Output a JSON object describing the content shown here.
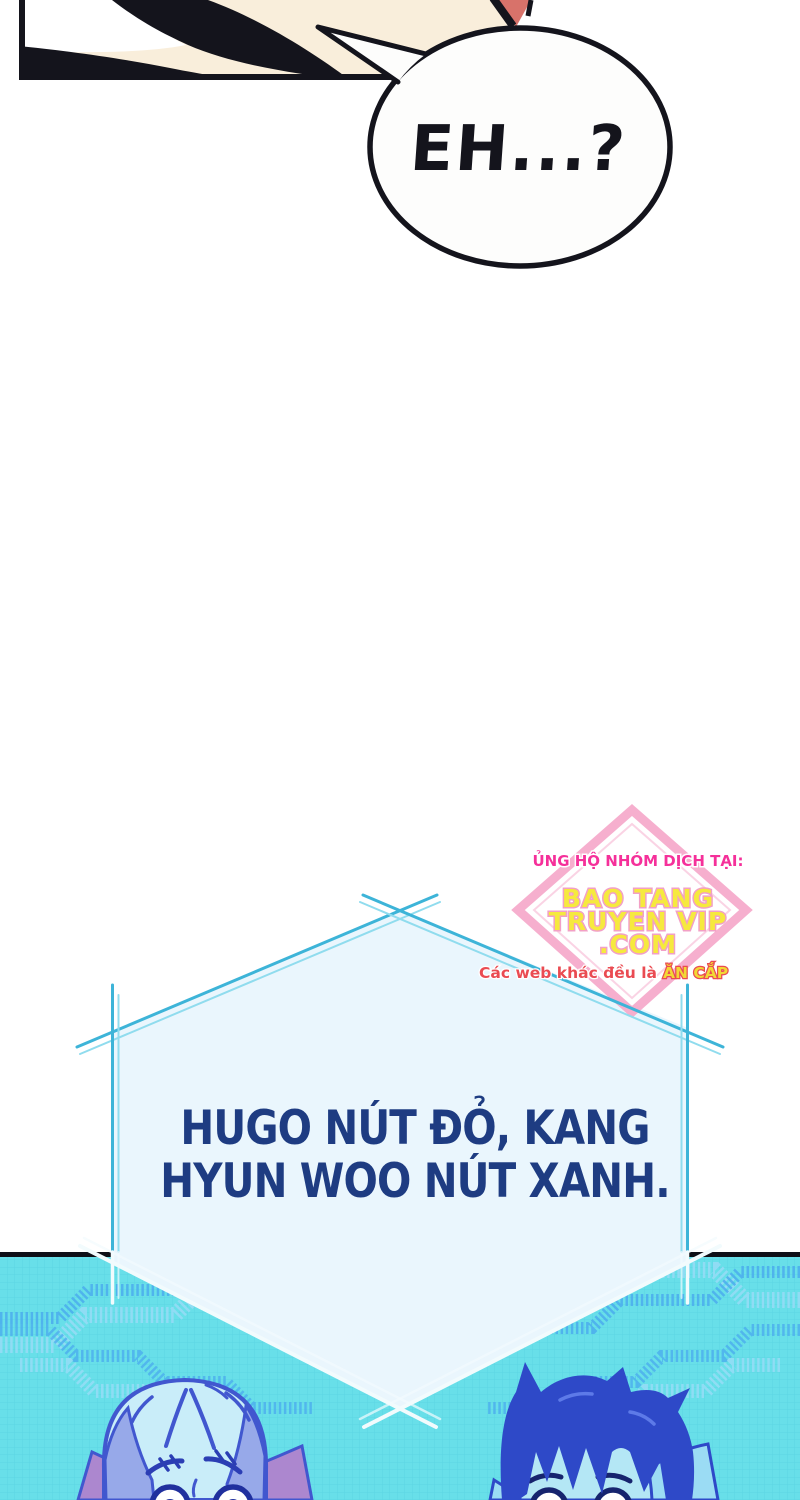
{
  "speech_bubble": {
    "text": "EH...?"
  },
  "hex_bubble": {
    "line1": "HUGO NÚT ĐỎ, KANG",
    "line2": "HYUN WOO NÚT XANH."
  },
  "watermark": {
    "support_line": "ỦNG HỘ NHÓM DỊCH TẠI:",
    "site_line1": "BAO TANG",
    "site_line2": "TRUYEN VIP",
    "site_line3": ".COM",
    "warning_prefix": "Các web khác đều là",
    "warning_emphasis": "ĂN CẮP"
  },
  "colors": {
    "page_bg": "#ffffff",
    "ink_black": "#14141c",
    "skin": "#f9eedb",
    "red_accent": "#d8726a",
    "bubble_fill": "#fdfdfc",
    "hex_fill": "#eaf6fd",
    "hex_line_cyan": "#3db4d8",
    "hex_line_light": "#90dcee",
    "hex_line_white": "#f2fbfd",
    "navy_text": "#1e3c82",
    "panel_cyan": "#68dfe9",
    "zigzag_blue": "#49a9ee",
    "zigzag_light": "#98dcf6",
    "diamond_pink": "#f6afce",
    "pink_text": "#f5309a",
    "yellow_text": "#f6e93e",
    "warning_red": "#ea4b52",
    "char_left_outline": "#4157cf",
    "char_left_face": "#c9edf9",
    "char_left_hairside": "#97a9e9",
    "char_left_collar": "#ac87cf",
    "char_right_hair": "#2e49c8",
    "char_right_face": "#b4e7f5",
    "char_right_collar": "#9bdcf4"
  }
}
